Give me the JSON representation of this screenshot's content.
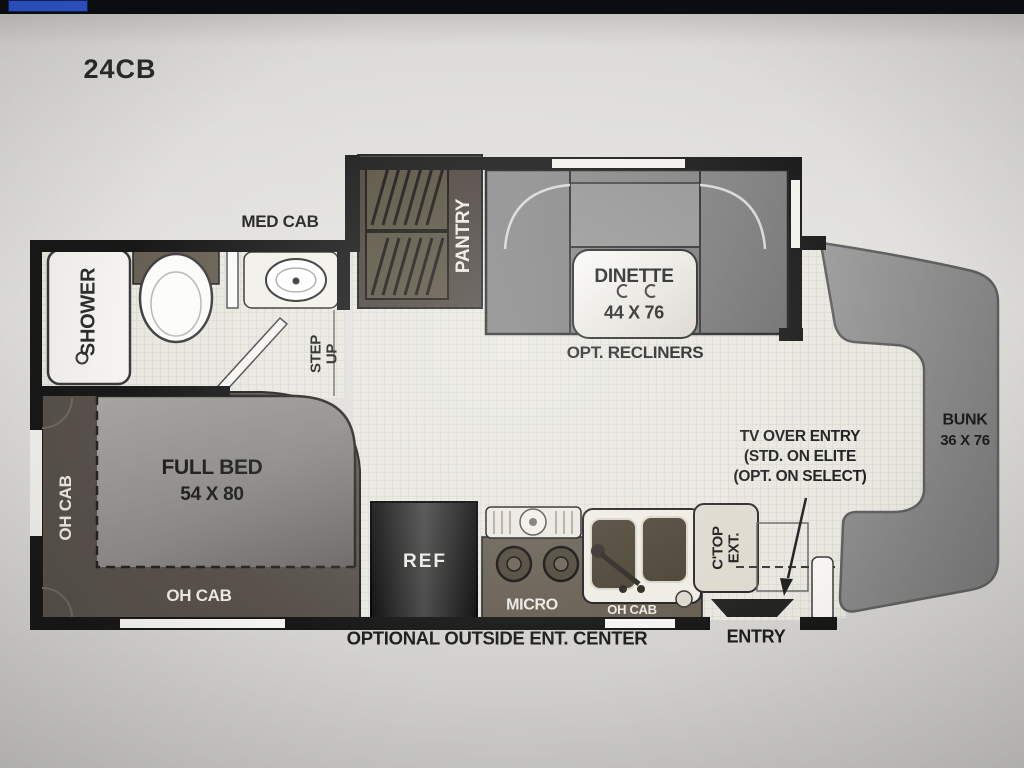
{
  "screen": {
    "model_label": "24CB"
  },
  "bathroom": {
    "med_cab": "MED CAB",
    "shower": "SHOWER",
    "step_up_line1": "STEP",
    "step_up_line2": "UP"
  },
  "slide_out": {
    "pantry": "PANTRY",
    "dinette_name": "DINETTE",
    "dinette_size": "44 X 76",
    "opt_recliners": "OPT. RECLINERS"
  },
  "bedroom": {
    "bed_name": "FULL BED",
    "bed_size": "54 X 80",
    "oh_cab_side": "OH CAB",
    "oh_cab_foot": "OH CAB"
  },
  "kitchen": {
    "ref": "REF",
    "micro": "MICRO",
    "oh_cab": "OH CAB",
    "ctop_line1": "C'TOP",
    "ctop_line2": "EXT.",
    "outside_center": "OPTIONAL OUTSIDE ENT. CENTER"
  },
  "front": {
    "tv_note_line1": "TV OVER ENTRY",
    "tv_note_line2": "(STD. ON ELITE",
    "tv_note_line3": "(OPT. ON SELECT)",
    "bunk_name": "BUNK",
    "bunk_size": "36 X 76",
    "entry": "ENTRY"
  },
  "colors": {
    "screen_band": "#0b0e11",
    "accent_chip_blue": "#2f55cc",
    "wall_black": "#181818",
    "floor_tile": "#e8e7e0",
    "cabinet_olive": "#675f52",
    "platform_olive": "#57514a",
    "cab_gray": "#8e8e8e",
    "ref_black": "#141414",
    "fixture_white": "#f4f3ef"
  }
}
